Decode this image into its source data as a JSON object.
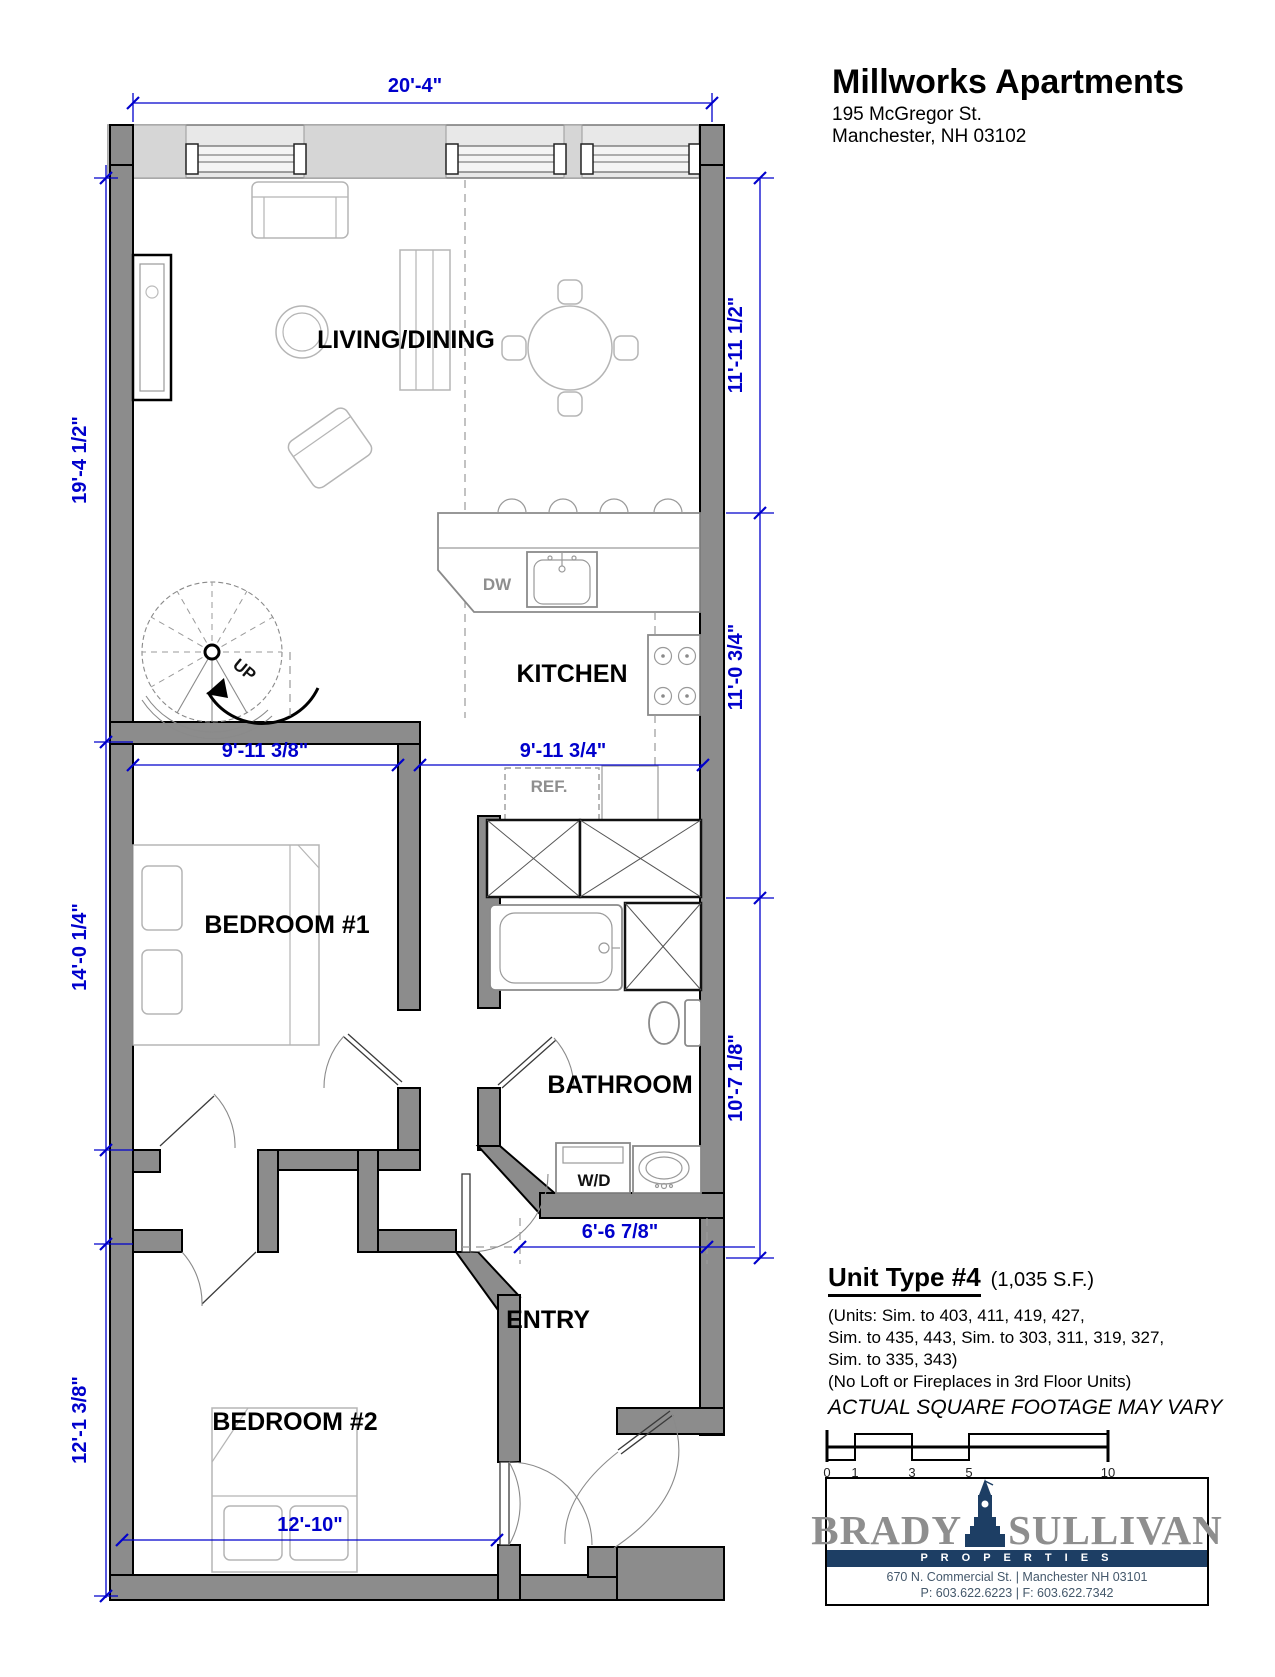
{
  "title_block": {
    "name": "Millworks Apartments",
    "address1": "195 McGregor St.",
    "address2": "Manchester, NH 03102"
  },
  "rooms": {
    "living_dining": "LIVING/DINING",
    "kitchen": "KITCHEN",
    "bedroom1": "BEDROOM #1",
    "bedroom2": "BEDROOM #2",
    "bathroom": "BATHROOM",
    "entry": "ENTRY"
  },
  "fixtures": {
    "dw": "DW",
    "ref": "REF.",
    "wd": "W/D",
    "up": "UP"
  },
  "dimensions": {
    "top_width": "20'-4\"",
    "left_upper": "19'-4 1/2\"",
    "left_middle": "14'-0 1/4\"",
    "left_lower": "12'-1 3/8\"",
    "right_upper": "11'-11 1/2\"",
    "right_middle": "11'-0 3/4\"",
    "right_lower": "10'-7 1/8\"",
    "bedroom1_width": "9'-11 3/8\"",
    "kitchen_width": "9'-11 3/4\"",
    "entry_width": "6'-6 7/8\"",
    "bedroom2_width": "12'-10\""
  },
  "unit_info": {
    "type_label": "Unit Type #4",
    "sqft": "(1,035 S.F.)",
    "units_line1": "(Units: Sim. to 403, 411, 419, 427,",
    "units_line2": "Sim. to 435, 443, Sim. to 303, 311, 319, 327,",
    "units_line3": "Sim. to 335, 343)",
    "note": "(No Loft or Fireplaces in 3rd Floor Units)",
    "disclaimer": "ACTUAL SQUARE FOOTAGE MAY VARY"
  },
  "scale_bar": {
    "ticks": [
      "0",
      "1",
      "3",
      "5",
      "10"
    ]
  },
  "logo": {
    "brady": "BRADY",
    "sullivan": "SULLIVAN",
    "properties": "P R O P E R T I E S",
    "address": "670 N. Commercial St. | Manchester NH 03101",
    "phone": "P: 603.622.6223 | F: 603.622.7342"
  },
  "colors": {
    "dimension_blue": "#0000cc",
    "wall_gray": "#8c8c8c",
    "logo_navy": "#1d3e64",
    "logo_gray": "#8e8e8e"
  }
}
